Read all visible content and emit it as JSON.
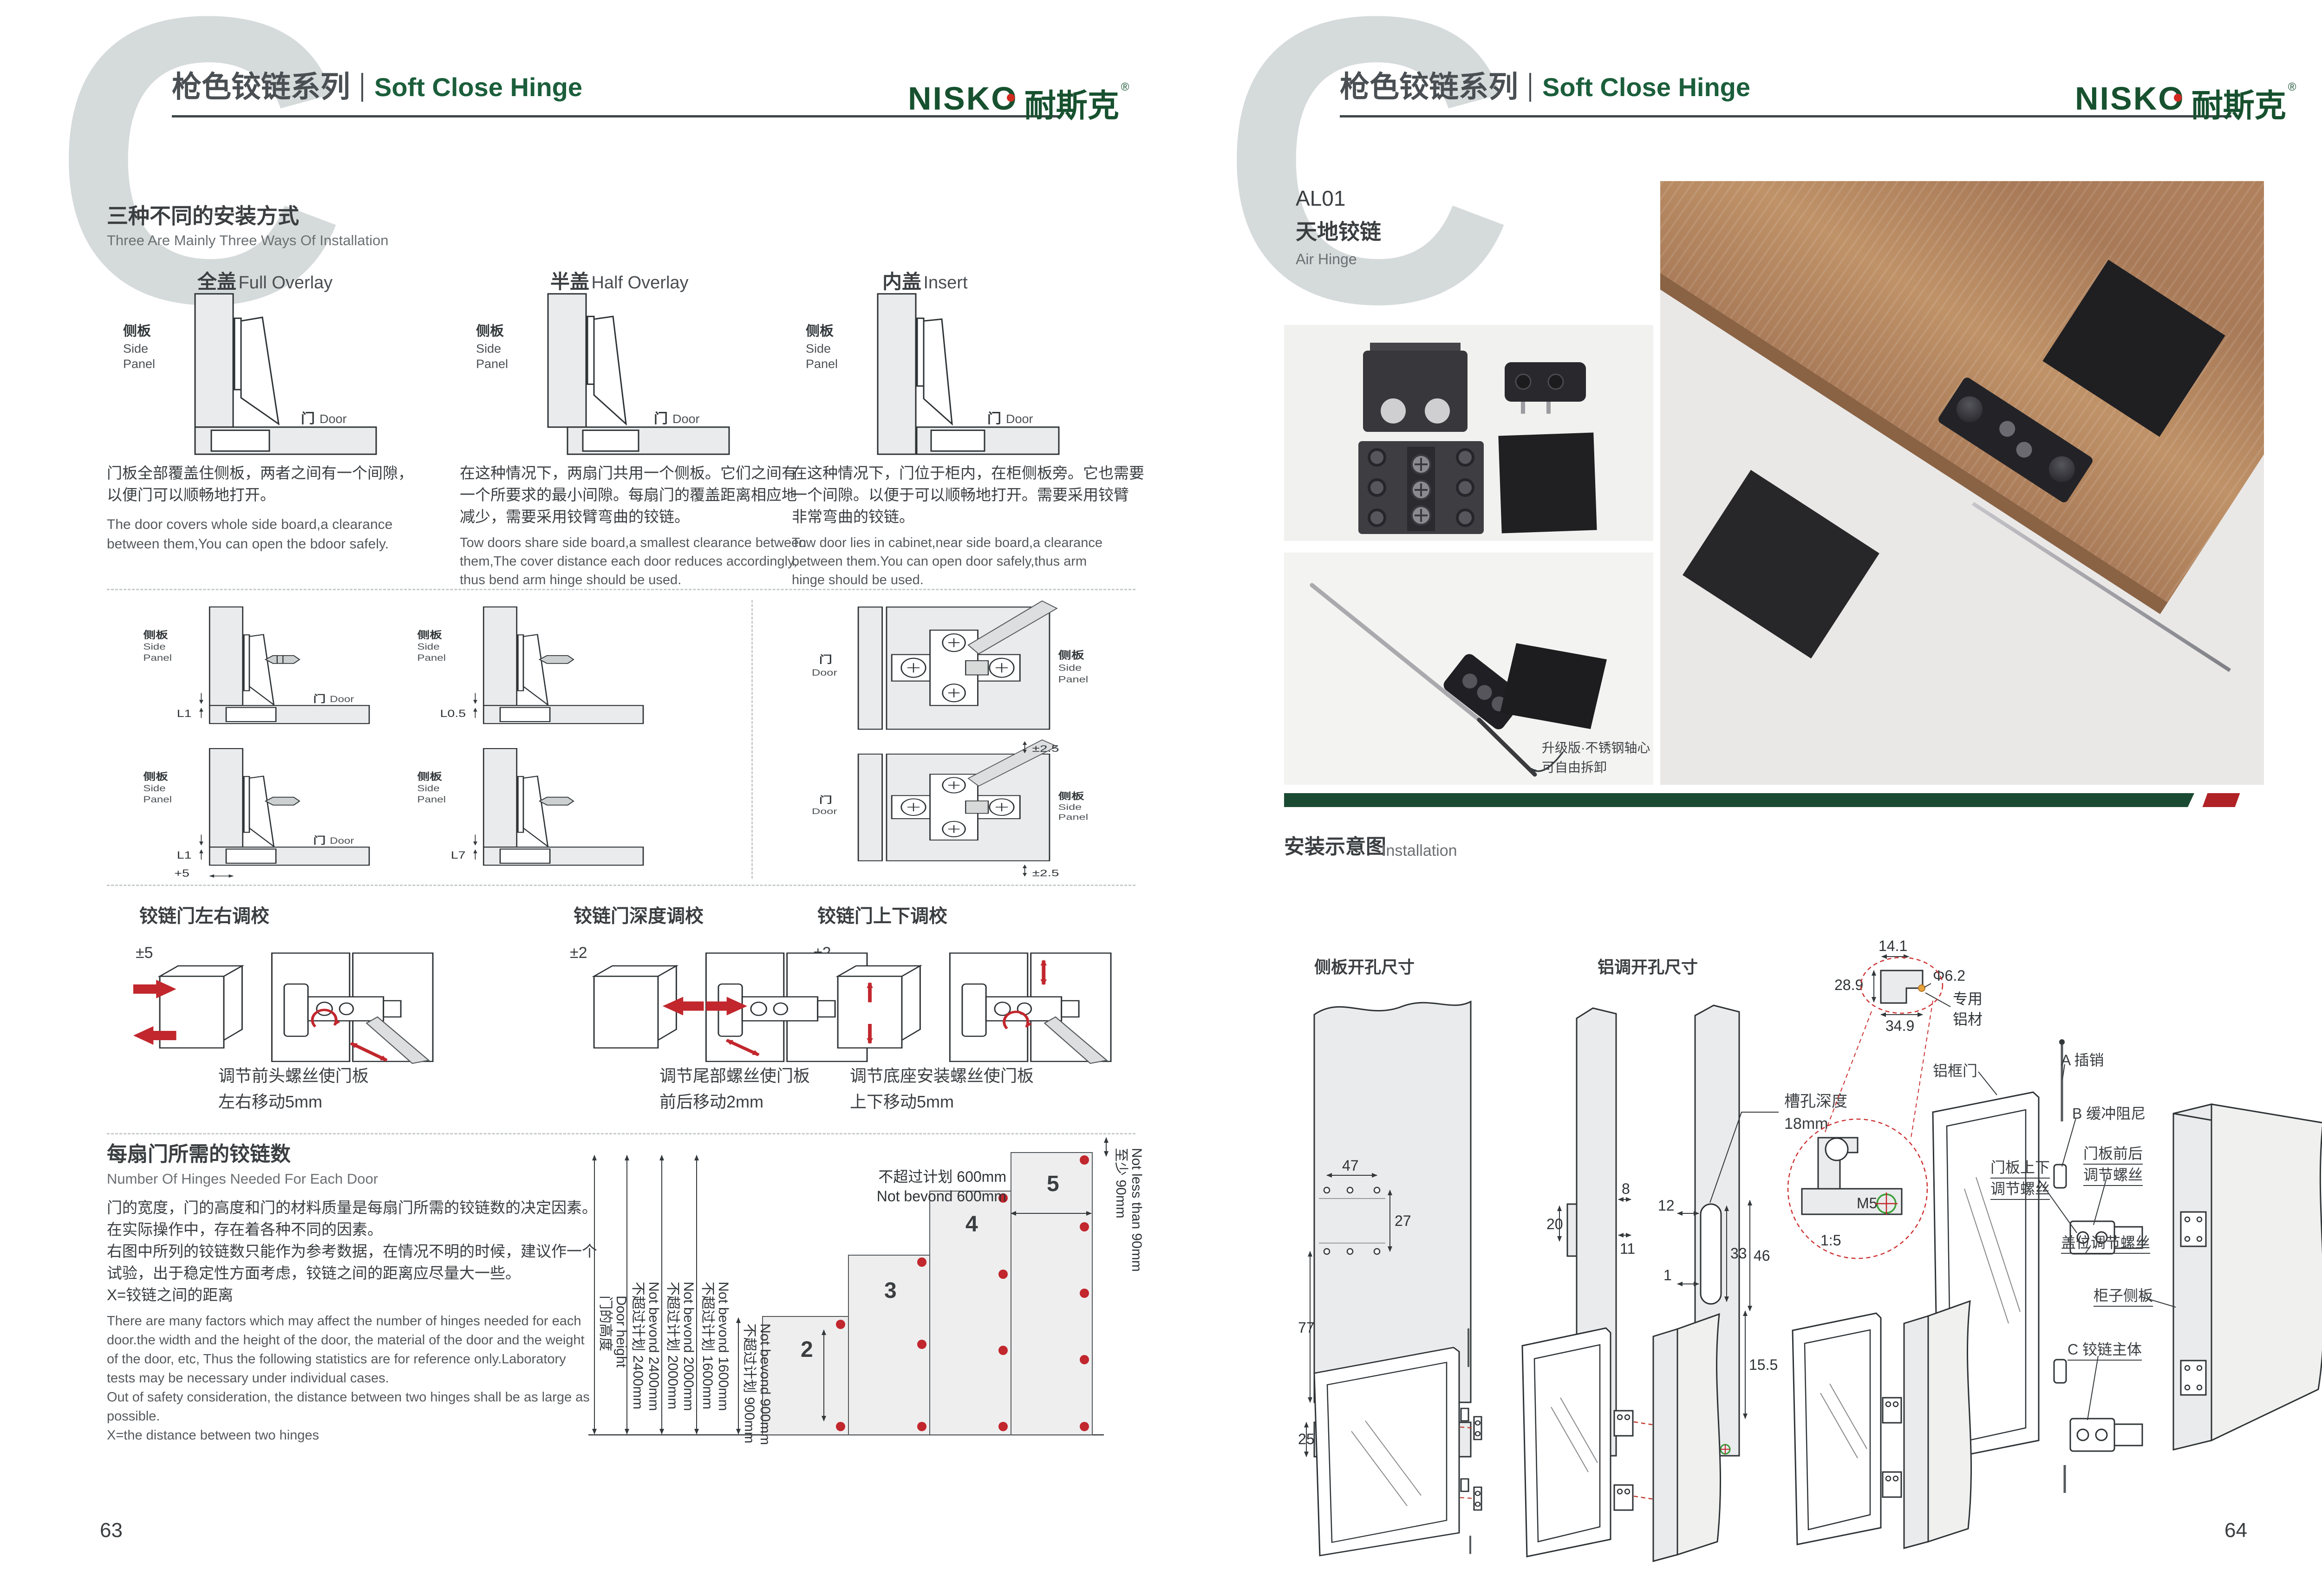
{
  "header": {
    "letter": "C",
    "series_cn": "枪色铰链系列",
    "series_en": "Soft Close Hinge",
    "logo_text": "NISKO",
    "logo_cn": "耐斯克",
    "logo_reg": "®"
  },
  "labels": {
    "side_cn": "侧板",
    "side_en1": "Side",
    "side_en2": "Panel",
    "door_cn": "门",
    "door_en": "Door"
  },
  "lp": {
    "num": "63",
    "ways": {
      "title_cn": "三种不同的安装方式",
      "title_en": "Three Are Mainly Three Ways Of Installation",
      "cols": [
        {
          "title_cn": "全盖",
          "title_en": "Full Overlay",
          "cn": [
            "门板全部覆盖住侧板，两者之间有一个间隙，",
            "以便门可以顺畅地打开。"
          ],
          "en": [
            "The door covers whole side board,a clearance",
            "between them,You can open the bdoor safely."
          ]
        },
        {
          "title_cn": "半盖",
          "title_en": "Half Overlay",
          "cn": [
            "在这种情况下，两扇门共用一个侧板。它们之间有",
            "一个所要求的最小间隙。每扇门的覆盖距离相应地",
            "减少，需要采用铰臂弯曲的铰链。"
          ],
          "en": [
            "Tow doors share side board,a smallest clearance between",
            "them,The cover distance each door reduces accordingly,",
            "thus bend arm hinge should be used."
          ]
        },
        {
          "title_cn": "内盖",
          "title_en": "Insert",
          "cn": [
            "在这种情况下，门位于柜内，在柜侧板旁。它也需要",
            "一个间隙。以便于可以顺畅地打开。需要采用铰臂",
            "非常弯曲的铰链。"
          ],
          "en": [
            "Tow door lies in cabinet,near side board,a clearance",
            "between them.You can open door safely,thus arm",
            "hinge should be used."
          ]
        }
      ]
    },
    "off": {
      "l1": "L1",
      "l05": "L0.5",
      "l1b": "L1",
      "p5": "+5",
      "l7": "L7",
      "pm25": "±2.5"
    },
    "adj": [
      {
        "t": "铰链门左右调校",
        "tol": "±5",
        "c1": "调节前头螺丝使门板",
        "c2": "左右移动5mm"
      },
      {
        "t": "铰链门深度调校",
        "tol": "±2",
        "c1": "调节尾部螺丝使门板",
        "c2": "前后移动2mm"
      },
      {
        "t": "铰链门上下调校",
        "tol": "±2",
        "c1": "调节底座安装螺丝使门板",
        "c2": "上下移动5mm"
      }
    ],
    "hc": {
      "title_cn": "每扇门所需的铰链数",
      "title_en": "Number Of Hinges Needed For Each Door",
      "cn": [
        "门的宽度，门的高度和门的材料质量是每扇门所需的铰链数的决定因素。",
        "在实际操作中，存在着各种不同的因素。",
        "右图中所列的铰链数只能作为参考数据，在情况不明的时候，建议作一个",
        "试验，出于稳定性方面考虑，铰链之间的距离应尽量大一些。",
        "X=铰链之间的距离"
      ],
      "en": [
        "There are many factors which may affect the number of hinges needed for each",
        "door.the width and the height of the door, the material of the door and the weight",
        "of the door, etc, Thus the following statistics are for reference only.Laboratory",
        "tests may be necessary under individual cases.",
        "Out of safety consideration, the distance between two hinges shall be as large as",
        "possible.",
        "X=the distance between two hinges"
      ],
      "chart": {
        "type": "bar",
        "dh_cn": "门的高度",
        "dh_en": "Door height",
        "r2400_cn": "不超过计划 2400mm",
        "r2400_en": "Not bevond 2400mm",
        "r2000_cn": "不超过计划 2000mm",
        "r2000_en": "Not bevond 2000mm",
        "r1600_cn": "不超过计划 1600mm",
        "r1600_en": "Not bevond 1600mm",
        "r900_cn": "不超过计划 900mm",
        "r900_en": "Not bevond 900mm",
        "w600_cn": "不超过计划 600mm",
        "w600_en": "Not bevond 600mm",
        "min_cn": "至少 90mm",
        "min_en": "Not less than 90mm",
        "bars": [
          "2",
          "3",
          "4",
          "5"
        ]
      }
    }
  },
  "rp": {
    "num": "64",
    "prod": {
      "code": "AL01",
      "cn": "天地铰链",
      "en": "Air Hinge",
      "note1": "升级版·不锈钢轴心",
      "note2": "可自由拆卸"
    },
    "inst": {
      "title_cn": "安装示意图",
      "title_en": "Installation",
      "side_title": "侧板开孔尺寸",
      "alu_title": "铝调开孔尺寸",
      "slot1": "槽孔深度",
      "slot2": "18mm",
      "dims": {
        "d47": "47",
        "d27": "27",
        "d77": "77",
        "d25": "25",
        "d8": "8",
        "d20": "20",
        "d11": "11",
        "d12": "12",
        "d1": "1",
        "d33": "33",
        "d46": "46",
        "d155": "15.5",
        "m5": "M5",
        "d141": "14.1",
        "d289": "28.9",
        "d349": "34.9",
        "dia": "Φ6.2",
        "alu1": "专用",
        "alu2": "铝材",
        "scale": "1:5",
        "m5b": "M5"
      },
      "ex": {
        "door": "铝框门",
        "pin": "A 插销",
        "damper": "B 缓冲阻尼",
        "fb1": "门板前后",
        "fb2": "调节螺丝",
        "ud1": "门板上下",
        "ud2": "调节螺丝",
        "cover": "盖位调节螺丝",
        "side": "柜子侧板",
        "body": "C 铰链主体"
      }
    }
  },
  "colors": {
    "brand_green": "#1b5e3b",
    "bar_green": "#1b4a32",
    "bar_red": "#b02226",
    "dot_red": "#c1272d",
    "letter_gray": "#d5dadb",
    "panel_fill": "#eaebec",
    "text_dark": "#3a3e41",
    "text_gray": "#6b7073"
  }
}
